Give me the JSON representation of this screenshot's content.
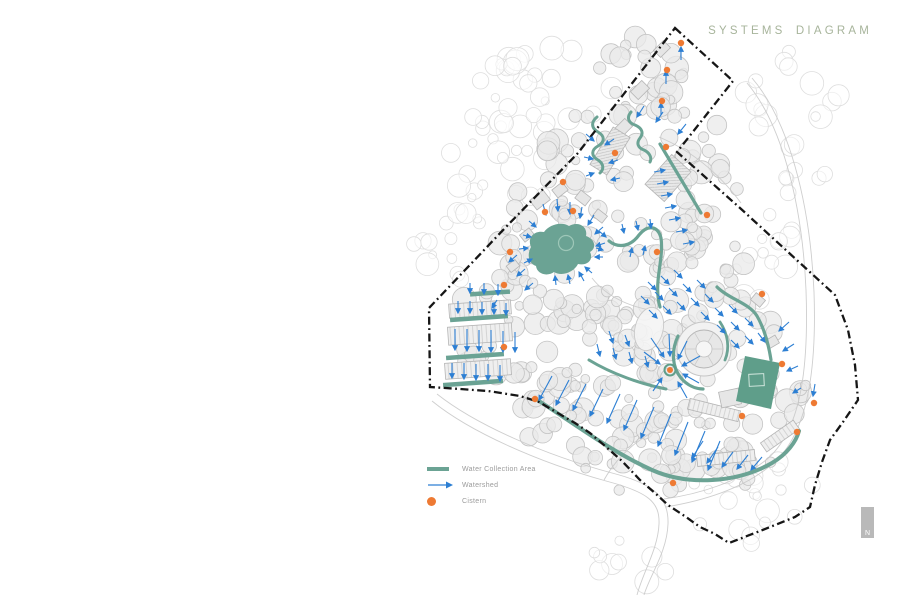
{
  "title": {
    "text": "SYSTEMS DIAGRAM",
    "color": "#a7b49b"
  },
  "legend": {
    "items": [
      {
        "key": "water",
        "label": "Water Collection Area"
      },
      {
        "key": "watershed",
        "label": "Watershed"
      },
      {
        "key": "cistern",
        "label": "Cistern"
      }
    ],
    "text_color": "#9b9b9b"
  },
  "north": {
    "label": "N"
  },
  "colors": {
    "water": "#6ba394",
    "water_dark": "#5f9e8a",
    "water_light_edge": "#9ec7b8",
    "watershed": "#2d7fd3",
    "cistern": "#ee7a33",
    "boundary": "#161616",
    "tree_out_stroke": "#dedede",
    "tree_in_stroke": "#c3c3c3",
    "tree_in_fill": "#eaeaea",
    "road": "#c9c9c9",
    "building_stroke": "#b5b5b5",
    "building_fill": "#e6e6e6",
    "north_bar": "#b9b9b9"
  },
  "map": {
    "seed": 7,
    "boundary": [
      [
        675,
        28
      ],
      [
        733,
        81
      ],
      [
        677,
        152
      ],
      [
        740,
        208
      ],
      [
        835,
        295
      ],
      [
        848,
        330
      ],
      [
        855,
        365
      ],
      [
        858,
        400
      ],
      [
        843,
        422
      ],
      [
        830,
        440
      ],
      [
        822,
        462
      ],
      [
        815,
        485
      ],
      [
        810,
        507
      ],
      [
        795,
        517
      ],
      [
        760,
        531
      ],
      [
        729,
        543
      ],
      [
        715,
        534
      ],
      [
        700,
        527
      ],
      [
        686,
        517
      ],
      [
        668,
        505
      ],
      [
        655,
        493
      ],
      [
        640,
        480
      ],
      [
        622,
        461
      ],
      [
        605,
        446
      ],
      [
        590,
        433
      ],
      [
        575,
        423
      ],
      [
        556,
        412
      ],
      [
        539,
        402
      ],
      [
        520,
        396
      ],
      [
        488,
        391
      ],
      [
        460,
        389
      ],
      [
        430,
        387
      ],
      [
        429,
        308
      ],
      [
        505,
        228
      ],
      [
        578,
        153
      ]
    ],
    "trees_out": [
      [
        497,
        168,
        62,
        58,
        24
      ],
      [
        556,
        82,
        58,
        42,
        18
      ],
      [
        449,
        252,
        40,
        48,
        14
      ],
      [
        795,
        125,
        55,
        75,
        22
      ],
      [
        762,
        255,
        38,
        50,
        13
      ],
      [
        748,
        502,
        72,
        48,
        24
      ],
      [
        640,
        558,
        48,
        26,
        9
      ],
      [
        512,
        96,
        40,
        38,
        10
      ]
    ],
    "trees_in": [
      [
        643,
        72,
        48,
        38,
        20
      ],
      [
        604,
        150,
        58,
        42,
        24
      ],
      [
        552,
        222,
        60,
        48,
        24
      ],
      [
        500,
        332,
        55,
        45,
        20
      ],
      [
        644,
        252,
        68,
        55,
        28
      ],
      [
        718,
        322,
        58,
        55,
        24
      ],
      [
        600,
        420,
        82,
        40,
        28
      ],
      [
        698,
        442,
        62,
        38,
        22
      ],
      [
        772,
        402,
        40,
        33,
        12
      ],
      [
        580,
        312,
        45,
        35,
        16
      ],
      [
        660,
        352,
        38,
        28,
        12
      ],
      [
        530,
        280,
        40,
        32,
        14
      ],
      [
        620,
        330,
        40,
        30,
        14
      ],
      [
        700,
        260,
        45,
        40,
        16
      ],
      [
        672,
        395,
        45,
        30,
        12
      ],
      [
        640,
        470,
        55,
        30,
        16
      ],
      [
        740,
        470,
        45,
        28,
        14
      ],
      [
        560,
        380,
        50,
        30,
        14
      ],
      [
        690,
        120,
        40,
        45,
        16
      ],
      [
        710,
        180,
        35,
        40,
        12
      ]
    ],
    "roads": [
      "M432,401 C470,432 538,462 606,481 C648,492 660,502 659,524 C658,549 643,572 637,595",
      "M437,394 C476,425 545,455 612,473 C655,484 669,498 668,524 C667,552 650,575 644,595",
      "M747,83 C780,122 802,198 806,290 C809,372 800,432 766,460 C738,482 700,494 664,499",
      "M752,78 C788,120 810,200 814,292 C817,376 806,438 770,466 C742,489 702,501 666,507",
      "M659,137 C690,150 718,172 741,203",
      "M604,480 C618,455 640,436 668,425",
      "M592,278 C606,296 628,306 650,310"
    ],
    "buildings": [
      [
        662,
        49,
        -45,
        14,
        10,
        ""
      ],
      [
        640,
        90,
        -45,
        16,
        11,
        ""
      ],
      [
        623,
        128,
        -45,
        16,
        11,
        ""
      ],
      [
        610,
        151,
        32,
        20,
        44,
        "hatch"
      ],
      [
        668,
        178,
        42,
        26,
        40,
        "hatch"
      ],
      [
        540,
        200,
        -38,
        17,
        12,
        ""
      ],
      [
        560,
        190,
        -38,
        13,
        10,
        ""
      ],
      [
        583,
        198,
        38,
        13,
        10,
        ""
      ],
      [
        600,
        216,
        38,
        12,
        9,
        ""
      ],
      [
        527,
        235,
        -38,
        12,
        9,
        ""
      ],
      [
        513,
        266,
        -38,
        11,
        8,
        ""
      ],
      [
        480,
        309,
        -4,
        62,
        14,
        "stall"
      ],
      [
        480,
        334,
        -4,
        64,
        18,
        "stall"
      ],
      [
        478,
        369,
        -4,
        66,
        16,
        "stall"
      ],
      [
        714,
        410,
        14,
        52,
        11,
        "stall"
      ],
      [
        726,
        458,
        -6,
        58,
        11,
        "stall"
      ],
      [
        780,
        436,
        -35,
        40,
        11,
        "stall"
      ],
      [
        730,
        398,
        -12,
        20,
        16,
        ""
      ],
      [
        758,
        300,
        40,
        12,
        9,
        ""
      ],
      [
        772,
        342,
        -30,
        12,
        9,
        ""
      ]
    ],
    "landmark_circle": {
      "cx": 704,
      "cy": 349
    },
    "plaza_ellipse": {
      "cx": 649,
      "cy": 329,
      "rx": 14,
      "ry": 22,
      "rot": 14
    },
    "water": [
      {
        "type": "blob",
        "d": "M531,247 C527,238 534,230 544,232 C549,225 561,221 569,226 C578,221 588,226 586,236 C595,239 597,248 590,252 C594,260 587,266 578,264 C574,272 562,277 554,272 C547,277 537,274 536,266 C528,263 527,254 531,247 Z"
      },
      {
        "type": "island",
        "cx": 566,
        "cy": 243,
        "r": 7.5
      },
      {
        "type": "stroke",
        "d": "M597,117 c-6,5 -6,11 1,15 c7,4 7,10 0,14 c-7,4 -7,10 0,14 c6,4 6,9 2,13",
        "w": 3
      },
      {
        "type": "stroke",
        "d": "M631,112 c-5,6 -2,11 4,13 c7,3 9,8 5,13 c-4,5 -2,10 4,12 c6,3 8,8 6,12",
        "w": 3
      },
      {
        "type": "stroke",
        "d": "M660,144 L701,213",
        "w": 3.2
      },
      {
        "type": "stroke",
        "d": "M609,241 C619,249 631,246 639,235 C648,224 658,226 661,238 C663,252 659,268 658,281 C657,293 658,300 660,307",
        "w": 3.2
      },
      {
        "type": "stroke",
        "d": "M717,287 C729,299 749,303 757,316 C765,330 769,347 771,360",
        "w": 3.2
      },
      {
        "type": "stroke",
        "d": "M678,336 C671,351 672,367 681,378 C687,385 695,389 703,389",
        "w": 3.2
      },
      {
        "type": "stroke",
        "d": "M720,322 C728,334 730,348 725,360",
        "w": 2.8
      },
      {
        "type": "stroke",
        "d": "M589,360 C612,374 641,384 666,389",
        "w": 3
      },
      {
        "type": "stroke",
        "d": "M539,401 C573,423 612,452 652,470 C688,486 737,483 772,463 C787,454 796,442 799,431",
        "w": 4
      },
      {
        "type": "poly",
        "pts": [
          [
            745,
            356
          ],
          [
            780,
            363
          ],
          [
            771,
            409
          ],
          [
            736,
            401
          ]
        ]
      },
      {
        "type": "rect-outline",
        "x": 749,
        "y": 374,
        "w": 15,
        "h": 12,
        "rot": -3
      },
      {
        "type": "bar",
        "cx": 490,
        "cy": 293,
        "w": 40,
        "rot": -4
      },
      {
        "type": "bar",
        "cx": 479,
        "cy": 318,
        "w": 58,
        "rot": -4
      },
      {
        "type": "bar",
        "cx": 475,
        "cy": 356,
        "w": 58,
        "rot": -4
      },
      {
        "type": "bar",
        "cx": 473,
        "cy": 383,
        "w": 60,
        "rot": -4
      }
    ],
    "arrows": [
      [
        681,
        60,
        681,
        47
      ],
      [
        666,
        84,
        666,
        71
      ],
      [
        661,
        115,
        661,
        103
      ],
      [
        644,
        106,
        637,
        117
      ],
      [
        663,
        112,
        656,
        122
      ],
      [
        686,
        124,
        678,
        134
      ],
      [
        586,
        134,
        594,
        141
      ],
      [
        584,
        157,
        593,
        159
      ],
      [
        586,
        176,
        594,
        173
      ],
      [
        614,
        139,
        605,
        145
      ],
      [
        618,
        160,
        609,
        163
      ],
      [
        620,
        178,
        611,
        180
      ],
      [
        654,
        172,
        665,
        170
      ],
      [
        657,
        184,
        668,
        182
      ],
      [
        661,
        196,
        672,
        194
      ],
      [
        665,
        208,
        676,
        206
      ],
      [
        669,
        220,
        680,
        218
      ],
      [
        676,
        232,
        687,
        230
      ],
      [
        683,
        244,
        694,
        242
      ],
      [
        543,
        204,
        546,
        215
      ],
      [
        557,
        199,
        558,
        211
      ],
      [
        570,
        202,
        570,
        214
      ],
      [
        582,
        207,
        580,
        218
      ],
      [
        594,
        215,
        588,
        225
      ],
      [
        603,
        227,
        595,
        234
      ],
      [
        605,
        243,
        596,
        246
      ],
      [
        603,
        257,
        595,
        257
      ],
      [
        592,
        273,
        585,
        267
      ],
      [
        584,
        281,
        579,
        272
      ],
      [
        570,
        284,
        568,
        275
      ],
      [
        556,
        285,
        555,
        276
      ],
      [
        524,
        263,
        532,
        259
      ],
      [
        519,
        249,
        528,
        248
      ],
      [
        523,
        235,
        531,
        237
      ],
      [
        529,
        221,
        536,
        227
      ],
      [
        517,
        255,
        509,
        262
      ],
      [
        525,
        269,
        517,
        276
      ],
      [
        533,
        283,
        525,
        290
      ],
      [
        497,
        300,
        492,
        308
      ],
      [
        470,
        283,
        470,
        293
      ],
      [
        484,
        283,
        484,
        294
      ],
      [
        498,
        284,
        498,
        295
      ],
      [
        458,
        301,
        458,
        313
      ],
      [
        470,
        301,
        470,
        313
      ],
      [
        482,
        302,
        482,
        314
      ],
      [
        494,
        302,
        494,
        314
      ],
      [
        506,
        303,
        506,
        315
      ],
      [
        455,
        329,
        455,
        350
      ],
      [
        467,
        329,
        467,
        351
      ],
      [
        479,
        330,
        479,
        351
      ],
      [
        491,
        330,
        491,
        352
      ],
      [
        503,
        331,
        503,
        352
      ],
      [
        515,
        332,
        515,
        352
      ],
      [
        452,
        363,
        452,
        378
      ],
      [
        464,
        363,
        464,
        379
      ],
      [
        476,
        364,
        476,
        380
      ],
      [
        488,
        364,
        488,
        380
      ],
      [
        500,
        365,
        500,
        381
      ],
      [
        644,
        352,
        660,
        364
      ],
      [
        651,
        338,
        664,
        357
      ],
      [
        669,
        334,
        670,
        356
      ],
      [
        687,
        341,
        678,
        359
      ],
      [
        700,
        356,
        682,
        366
      ],
      [
        699,
        383,
        683,
        374
      ],
      [
        687,
        398,
        678,
        382
      ],
      [
        653,
        391,
        662,
        378
      ],
      [
        648,
        282,
        656,
        290
      ],
      [
        661,
        276,
        669,
        284
      ],
      [
        674,
        270,
        682,
        278
      ],
      [
        641,
        296,
        649,
        304
      ],
      [
        655,
        292,
        663,
        300
      ],
      [
        669,
        288,
        677,
        296
      ],
      [
        683,
        284,
        691,
        292
      ],
      [
        697,
        280,
        705,
        288
      ],
      [
        649,
        310,
        657,
        318
      ],
      [
        663,
        306,
        671,
        314
      ],
      [
        677,
        302,
        685,
        310
      ],
      [
        691,
        298,
        699,
        306
      ],
      [
        705,
        294,
        713,
        302
      ],
      [
        701,
        312,
        709,
        320
      ],
      [
        715,
        308,
        723,
        316
      ],
      [
        729,
        305,
        737,
        313
      ],
      [
        717,
        325,
        725,
        333
      ],
      [
        731,
        322,
        739,
        330
      ],
      [
        745,
        318,
        753,
        326
      ],
      [
        731,
        340,
        739,
        348
      ],
      [
        745,
        336,
        753,
        344
      ],
      [
        758,
        333,
        765,
        342
      ],
      [
        789,
        322,
        779,
        331
      ],
      [
        794,
        344,
        783,
        351
      ],
      [
        798,
        366,
        787,
        371
      ],
      [
        801,
        388,
        793,
        393
      ],
      [
        815,
        384,
        813,
        396
      ],
      [
        622,
        224,
        624,
        233
      ],
      [
        636,
        221,
        638,
        230
      ],
      [
        650,
        219,
        651,
        228
      ],
      [
        599,
        231,
        606,
        237
      ],
      [
        596,
        248,
        603,
        250
      ],
      [
        630,
        257,
        632,
        248
      ],
      [
        643,
        255,
        645,
        246
      ],
      [
        597,
        344,
        600,
        356
      ],
      [
        613,
        348,
        616,
        359
      ],
      [
        629,
        352,
        632,
        363
      ],
      [
        645,
        356,
        648,
        367
      ],
      [
        609,
        331,
        613,
        343
      ],
      [
        625,
        335,
        629,
        346
      ],
      [
        552,
        376,
        539,
        400
      ],
      [
        569,
        380,
        556,
        405
      ],
      [
        586,
        384,
        573,
        410
      ],
      [
        603,
        389,
        590,
        416
      ],
      [
        620,
        394,
        607,
        423
      ],
      [
        637,
        400,
        624,
        430
      ],
      [
        654,
        407,
        641,
        438
      ],
      [
        671,
        414,
        658,
        446
      ],
      [
        688,
        422,
        675,
        455
      ],
      [
        705,
        431,
        692,
        462
      ],
      [
        720,
        441,
        708,
        470
      ],
      [
        703,
        441,
        692,
        458
      ],
      [
        718,
        447,
        707,
        463
      ],
      [
        733,
        452,
        722,
        467
      ],
      [
        748,
        455,
        737,
        469
      ],
      [
        762,
        457,
        751,
        470
      ]
    ],
    "cisterns": [
      [
        681,
        43
      ],
      [
        667,
        70
      ],
      [
        662,
        101
      ],
      [
        666,
        147
      ],
      [
        615,
        153
      ],
      [
        563,
        182
      ],
      [
        545,
        212
      ],
      [
        573,
        211
      ],
      [
        657,
        252
      ],
      [
        510,
        252
      ],
      [
        504,
        285
      ],
      [
        504,
        347
      ],
      [
        535,
        399
      ],
      [
        707,
        215
      ],
      [
        762,
        294
      ],
      [
        782,
        364
      ],
      [
        814,
        403
      ],
      [
        797,
        432
      ],
      [
        742,
        416
      ],
      [
        673,
        483
      ]
    ],
    "hub": {
      "cx": 670,
      "cy": 370
    },
    "north_bar": {
      "x": 861,
      "y": 507,
      "w": 13,
      "h": 31
    }
  }
}
